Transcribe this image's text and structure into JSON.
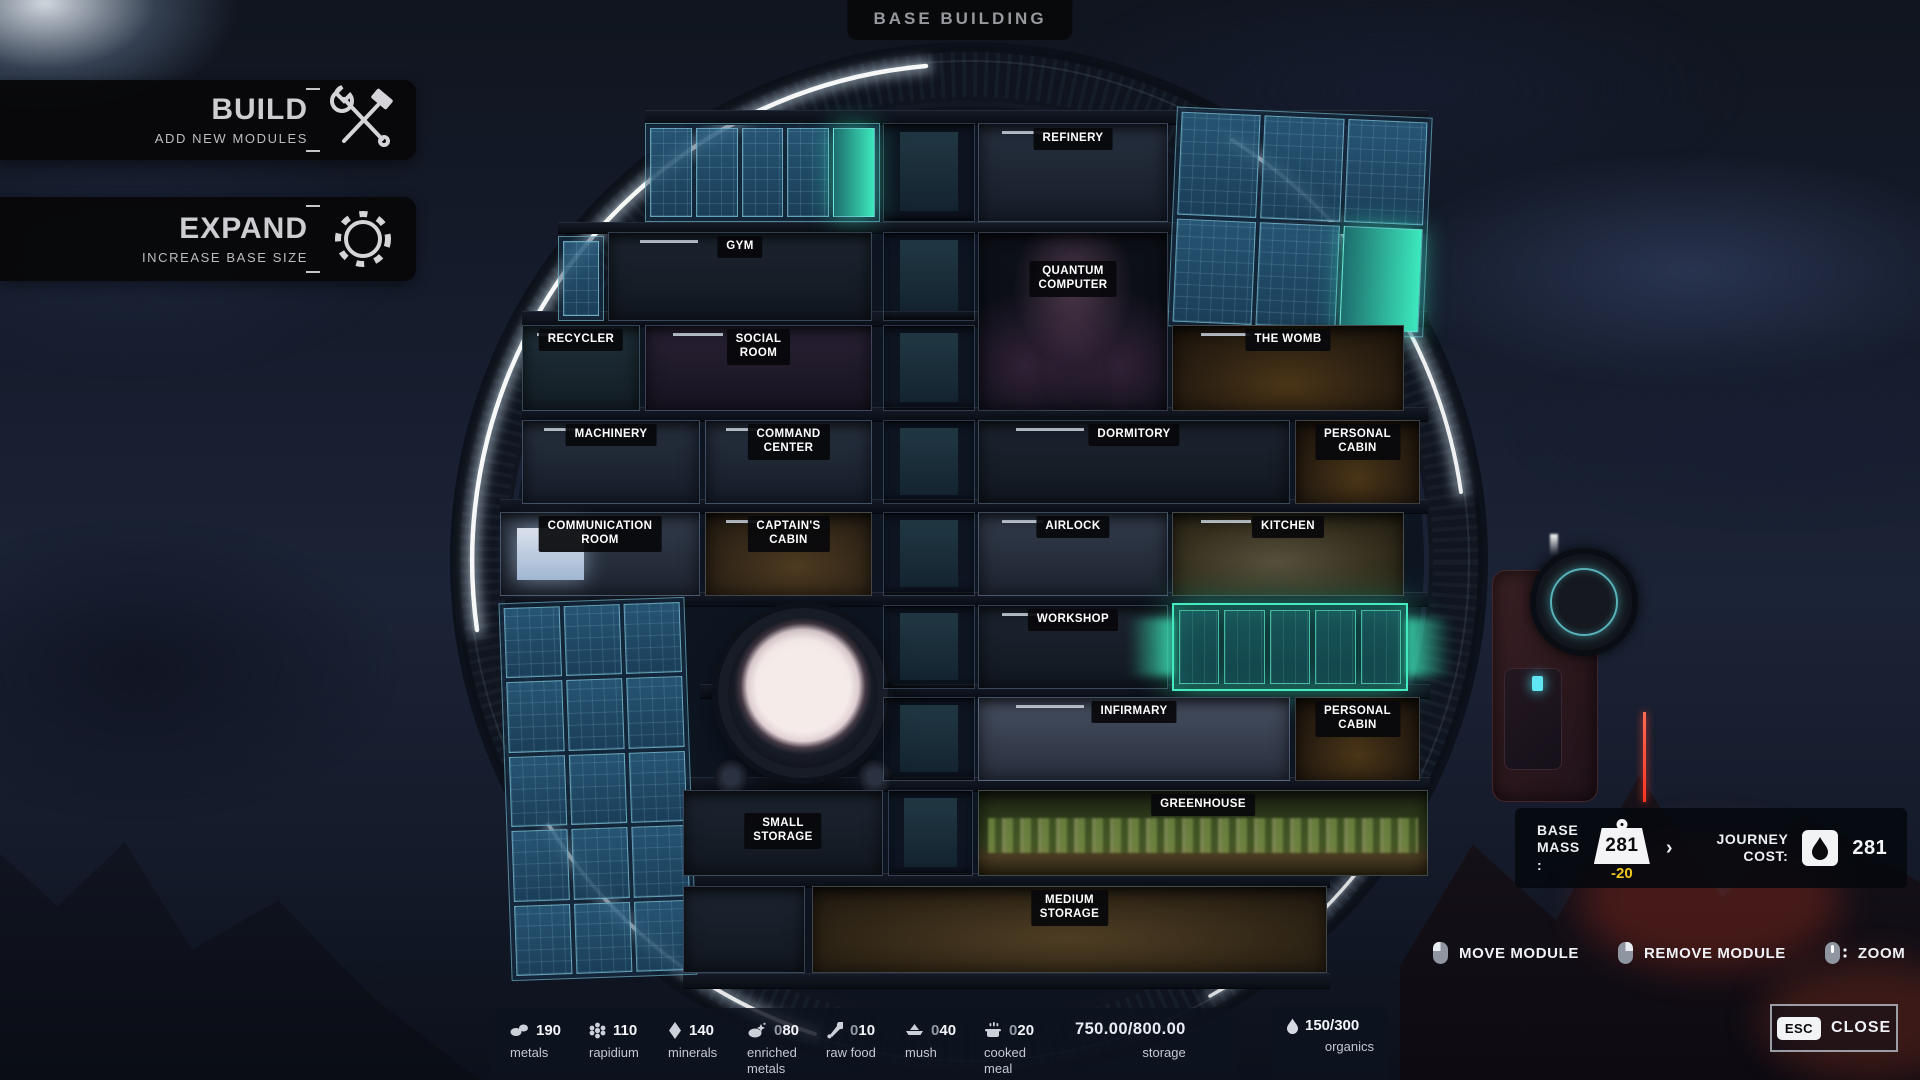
{
  "title": "BASE BUILDING",
  "left_menu": {
    "build": {
      "label": "BUILD",
      "sublabel": "ADD NEW MODULES"
    },
    "expand": {
      "label": "EXPAND",
      "sublabel": "INCREASE BASE SIZE"
    }
  },
  "modules": [
    {
      "label": "REFINERY"
    },
    {
      "label": "GYM"
    },
    {
      "label": "QUANTUM\nCOMPUTER"
    },
    {
      "label": "RECYCLER"
    },
    {
      "label": "SOCIAL\nROOM"
    },
    {
      "label": "THE WOMB"
    },
    {
      "label": "MACHINERY"
    },
    {
      "label": "COMMAND\nCENTER"
    },
    {
      "label": "DORMITORY"
    },
    {
      "label": "PERSONAL\nCABIN"
    },
    {
      "label": "COMMUNICATION\nROOM"
    },
    {
      "label": "CAPTAIN'S\nCABIN"
    },
    {
      "label": "AIRLOCK"
    },
    {
      "label": "KITCHEN"
    },
    {
      "label": "WORKSHOP"
    },
    {
      "label": "INFIRMARY"
    },
    {
      "label": "PERSONAL\nCABIN"
    },
    {
      "label": "GREENHOUSE"
    },
    {
      "label": "SMALL\nSTORAGE"
    },
    {
      "label": "MEDIUM\nSTORAGE"
    }
  ],
  "mass_panel": {
    "base_mass_label": "BASE\nMASS :",
    "base_mass_value": "281",
    "mass_delta": "-20",
    "chevron": "›",
    "journey_cost_label": "JOURNEY\nCOST:",
    "journey_cost_value": "281"
  },
  "controls": {
    "move": "MOVE MODULE",
    "remove": "REMOVE MODULE",
    "zoom": "ZOOM"
  },
  "close_button": {
    "key": "ESC",
    "label": "CLOSE"
  },
  "resources": [
    {
      "name": "metals",
      "dim": "",
      "value": "190"
    },
    {
      "name": "rapidium",
      "dim": "",
      "value": "110"
    },
    {
      "name": "minerals",
      "dim": "",
      "value": "140"
    },
    {
      "name": "enriched\nmetals",
      "dim": "0",
      "value": "80"
    },
    {
      "name": "raw food",
      "dim": "0",
      "value": "10"
    },
    {
      "name": "mush",
      "dim": "0",
      "value": "40"
    },
    {
      "name": "cooked\nmeal",
      "dim": "0",
      "value": "20"
    }
  ],
  "storage": {
    "value": "750.00/800.00",
    "label": "storage"
  },
  "organics": {
    "value": "150/300",
    "label": "organics"
  },
  "colors": {
    "accent_teal": "#3fe9c0",
    "warning_yellow": "#eec71f",
    "laser_red": "#ff4433"
  }
}
